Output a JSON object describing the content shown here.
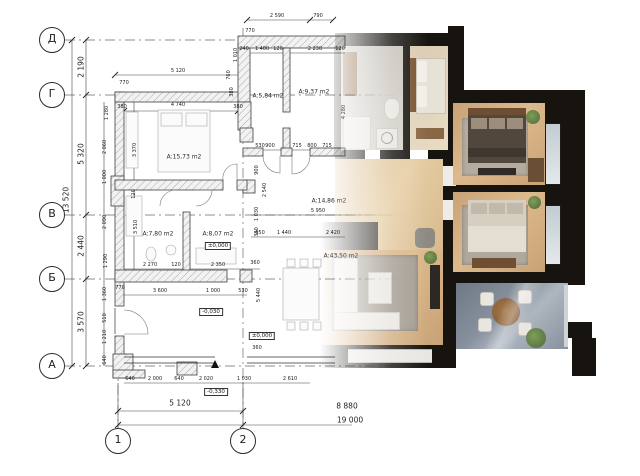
{
  "colors": {
    "wall": "#17140f",
    "wood": "#c8a276",
    "wood_light": "#d8bb90",
    "tile": "#c6c2bb",
    "terrace": "#87909d",
    "rug": "#a49c91",
    "bed_dark": "#51473d",
    "bed_light": "#d6cec1",
    "plant": "#5c7a43",
    "line": "#3a3a3a"
  },
  "axes": {
    "left": [
      {
        "label": "Д",
        "y": 40
      },
      {
        "label": "Г",
        "y": 95
      },
      {
        "label": "В",
        "y": 215
      },
      {
        "label": "Б",
        "y": 279
      },
      {
        "label": "А",
        "y": 366
      }
    ],
    "left_x": 52,
    "bottom": [
      {
        "label": "1",
        "x": 118
      },
      {
        "label": "2",
        "x": 243
      }
    ],
    "bottom_y": 441
  },
  "rooms": [
    {
      "t": "A:15,73 m2",
      "x": 184,
      "y": 157
    },
    {
      "t": "A:7,80 m2",
      "x": 158,
      "y": 234
    },
    {
      "t": "A:8,07 m2",
      "x": 218,
      "y": 234
    },
    {
      "t": "A:5,84 m2",
      "x": 268,
      "y": 96
    },
    {
      "t": "A:9,37 m2",
      "x": 314,
      "y": 92
    },
    {
      "t": "A:14,86 m2",
      "x": 329,
      "y": 201
    },
    {
      "t": "A:43,50 m2",
      "x": 341,
      "y": 256
    }
  ],
  "levels": [
    {
      "t": "±0,000",
      "x": 218,
      "y": 246
    },
    {
      "t": "-0,030",
      "x": 211,
      "y": 312
    },
    {
      "t": "±0,000",
      "x": 262,
      "y": 336
    },
    {
      "t": "-0,330",
      "x": 216,
      "y": 392
    }
  ],
  "dims": [
    {
      "t": "2 590",
      "x": 277,
      "y": 16
    },
    {
      "t": "790",
      "x": 318,
      "y": 16
    },
    {
      "t": "770",
      "x": 250,
      "y": 31
    },
    {
      "t": "240",
      "x": 244,
      "y": 49
    },
    {
      "t": "1 400",
      "x": 262,
      "y": 49
    },
    {
      "t": "120",
      "x": 278,
      "y": 49
    },
    {
      "t": "2 230",
      "x": 315,
      "y": 49
    },
    {
      "t": "120",
      "x": 340,
      "y": 49
    },
    {
      "t": "1 010",
      "x": 236,
      "y": 55,
      "r": 1
    },
    {
      "t": "760",
      "x": 229,
      "y": 75,
      "r": 1
    },
    {
      "t": "380",
      "x": 232,
      "y": 92,
      "r": 1
    },
    {
      "t": "5 120",
      "x": 178,
      "y": 71
    },
    {
      "t": "770",
      "x": 124,
      "y": 83
    },
    {
      "t": "380",
      "x": 122,
      "y": 107
    },
    {
      "t": "4 740",
      "x": 178,
      "y": 105
    },
    {
      "t": "380",
      "x": 238,
      "y": 107
    },
    {
      "t": "1 280",
      "x": 107,
      "y": 113,
      "r": 1
    },
    {
      "t": "2 060",
      "x": 105,
      "y": 147,
      "r": 1
    },
    {
      "t": "1 000",
      "x": 105,
      "y": 177,
      "r": 1
    },
    {
      "t": "2 090",
      "x": 105,
      "y": 222,
      "r": 1
    },
    {
      "t": "1 290",
      "x": 106,
      "y": 261,
      "r": 1
    },
    {
      "t": "1 360",
      "x": 105,
      "y": 294,
      "r": 1
    },
    {
      "t": "510",
      "x": 105,
      "y": 318,
      "r": 1
    },
    {
      "t": "1 210",
      "x": 105,
      "y": 337,
      "r": 1
    },
    {
      "t": "640",
      "x": 105,
      "y": 360,
      "r": 1
    },
    {
      "t": "3 370",
      "x": 135,
      "y": 150,
      "r": 1
    },
    {
      "t": "120",
      "x": 134,
      "y": 194,
      "r": 1
    },
    {
      "t": "3 510",
      "x": 136,
      "y": 227,
      "r": 1
    },
    {
      "t": "900",
      "x": 257,
      "y": 170,
      "r": 1
    },
    {
      "t": "2 540",
      "x": 265,
      "y": 190,
      "r": 1
    },
    {
      "t": "1 030",
      "x": 257,
      "y": 214,
      "r": 1
    },
    {
      "t": "380",
      "x": 257,
      "y": 232,
      "r": 1
    },
    {
      "t": "530",
      "x": 260,
      "y": 146
    },
    {
      "t": "900",
      "x": 270,
      "y": 146
    },
    {
      "t": "715",
      "x": 297,
      "y": 146
    },
    {
      "t": "800",
      "x": 312,
      "y": 146
    },
    {
      "t": "715",
      "x": 327,
      "y": 146
    },
    {
      "t": "4 280",
      "x": 344,
      "y": 112,
      "r": 1
    },
    {
      "t": "5 950",
      "x": 318,
      "y": 211
    },
    {
      "t": "650",
      "x": 260,
      "y": 233
    },
    {
      "t": "1 440",
      "x": 284,
      "y": 233
    },
    {
      "t": "2 420",
      "x": 333,
      "y": 233
    },
    {
      "t": "2 270",
      "x": 150,
      "y": 265
    },
    {
      "t": "120",
      "x": 176,
      "y": 265
    },
    {
      "t": "2 350",
      "x": 218,
      "y": 265
    },
    {
      "t": "360",
      "x": 255,
      "y": 263
    },
    {
      "t": "770",
      "x": 120,
      "y": 288
    },
    {
      "t": "3 600",
      "x": 160,
      "y": 291
    },
    {
      "t": "1 000",
      "x": 213,
      "y": 291
    },
    {
      "t": "530",
      "x": 243,
      "y": 291
    },
    {
      "t": "5 440",
      "x": 259,
      "y": 295,
      "r": 1
    },
    {
      "t": "360",
      "x": 257,
      "y": 348
    },
    {
      "t": "640",
      "x": 130,
      "y": 379
    },
    {
      "t": "2 000",
      "x": 155,
      "y": 379
    },
    {
      "t": "640",
      "x": 179,
      "y": 379
    },
    {
      "t": "2 020",
      "x": 206,
      "y": 379
    },
    {
      "t": "1 030",
      "x": 244,
      "y": 379
    },
    {
      "t": "2 610",
      "x": 290,
      "y": 379
    },
    {
      "t": "2 190",
      "x": 81,
      "y": 67,
      "r": 2
    },
    {
      "t": "5 320",
      "x": 81,
      "y": 154,
      "r": 2
    },
    {
      "t": "2 440",
      "x": 81,
      "y": 246,
      "r": 2
    },
    {
      "t": "3 570",
      "x": 81,
      "y": 322,
      "r": 2
    },
    {
      "t": "13 520",
      "x": 66,
      "y": 200,
      "r": 2
    },
    {
      "t": "5 120",
      "x": 180,
      "y": 403,
      "big": true
    },
    {
      "t": "8 880",
      "x": 347,
      "y": 406,
      "big": true
    },
    {
      "t": "19 000",
      "x": 350,
      "y": 420,
      "big": true
    }
  ]
}
